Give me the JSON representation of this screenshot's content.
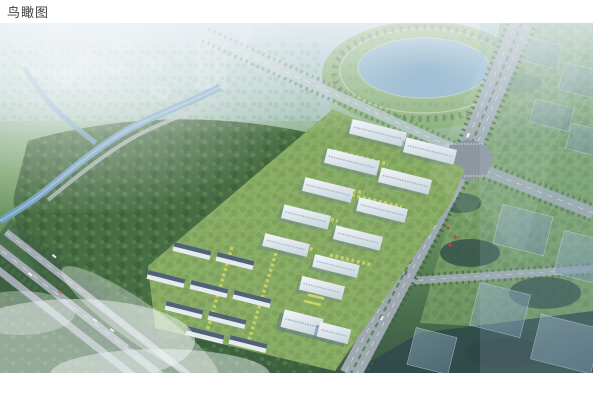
{
  "page": {
    "title": "鸟瞰图",
    "background_color": "#ffffff",
    "title_color": "#3f3f3f"
  },
  "figure": {
    "kind": "aerial-view-architectural-rendering",
    "caption": "鸟瞰图",
    "scene_elements": [
      "hazy-city-blocks",
      "lake",
      "lakeside-park",
      "forest-park",
      "river",
      "northwest-boulevard",
      "southwest-highway",
      "main-road",
      "intersection-plaza",
      "estate-platform",
      "residential-tower-slabs",
      "townhouse-rows",
      "courtyard-gardens",
      "ghost-buildings-north",
      "ghost-buildings-east",
      "mist-clouds"
    ],
    "palette": {
      "haze_blue": "#aecde0",
      "lake_blue": "#6396ba",
      "forest_green": "#3c6634",
      "lawn_green": "#7fa855",
      "accent_tree_yellow": "#cdd25c",
      "road_gray": "#99a3ab",
      "building_white": "#eef2f6",
      "building_shadow": "#617a8c",
      "townhouse_roof": "#44566a",
      "ghost_building_blue": "#6c8ba3",
      "dark_teal_green": "#24413b",
      "mist_white": "#eef4f2"
    }
  }
}
